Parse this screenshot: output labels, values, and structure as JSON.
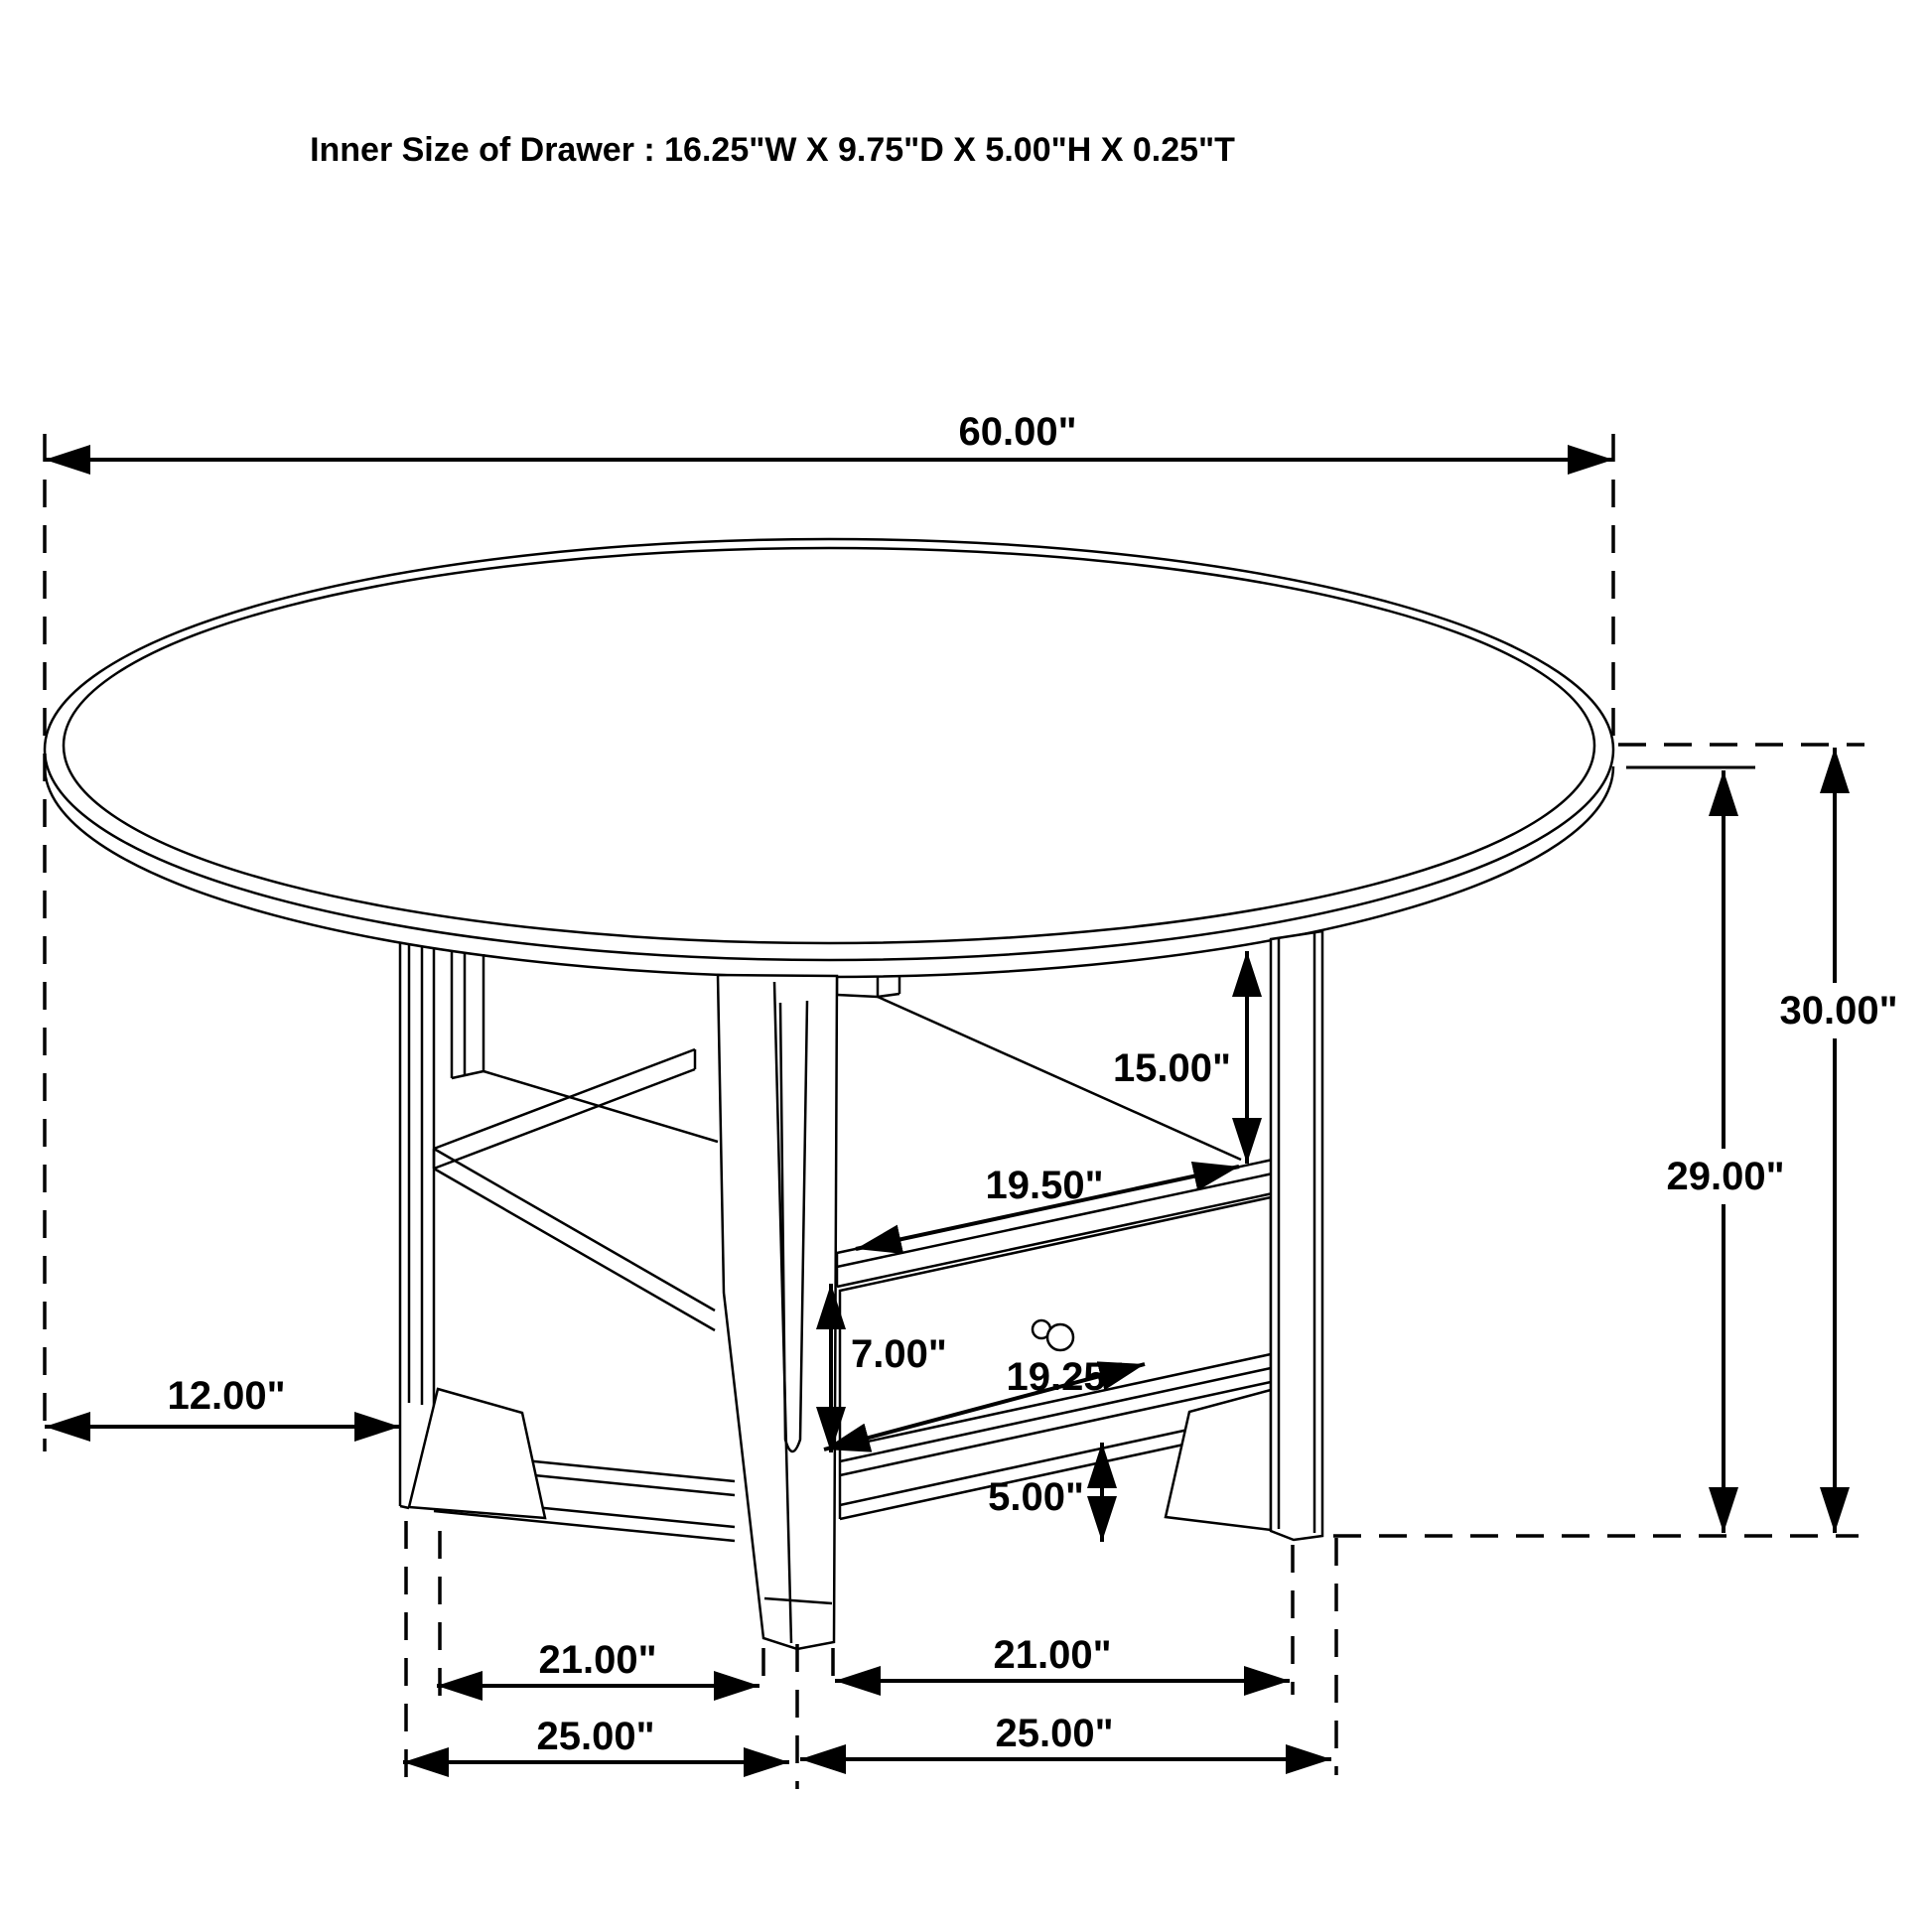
{
  "title": "Inner Size of Drawer : 16.25\"W X 9.75\"D X 5.00\"H X 0.25\"T",
  "drawing_type": "furniture dimension diagram, round drop-leaf storage dining table with drawer",
  "colors": {
    "ink": "#000000",
    "background": "#ffffff"
  },
  "dims": {
    "d60": {
      "label": "60.00\"",
      "inches": 60.0,
      "meaning": "tabletop diameter"
    },
    "d30": {
      "label": "30.00\"",
      "inches": 30.0,
      "meaning": "floor to tabletop surface"
    },
    "d29": {
      "label": "29.00\"",
      "inches": 29.0,
      "meaning": "floor to tabletop underside"
    },
    "d15": {
      "label": "15.00\"",
      "inches": 15.0,
      "meaning": "open shelf compartment height"
    },
    "d1950": {
      "label": "19.50\"",
      "inches": 19.5,
      "meaning": "shelf top rail width"
    },
    "d700": {
      "label": "7.00\"",
      "inches": 7.0,
      "meaning": "drawer front height"
    },
    "d1925": {
      "label": "19.25\"",
      "inches": 19.25,
      "meaning": "drawer opening width"
    },
    "d500": {
      "label": "5.00\"",
      "inches": 5.0,
      "meaning": "bottom rail to floor clearance"
    },
    "d12": {
      "label": "12.00\"",
      "inches": 12.0,
      "meaning": "tabletop side overhang"
    },
    "d21l": {
      "label": "21.00\"",
      "inches": 21.0,
      "meaning": "inner leg span, left/depth side"
    },
    "d21r": {
      "label": "21.00\"",
      "inches": 21.0,
      "meaning": "inner leg span, right/front side"
    },
    "d25l": {
      "label": "25.00\"",
      "inches": 25.0,
      "meaning": "outer leg span, left/depth side"
    },
    "d25r": {
      "label": "25.00\"",
      "inches": 25.0,
      "meaning": "outer leg span, right/front side"
    }
  }
}
